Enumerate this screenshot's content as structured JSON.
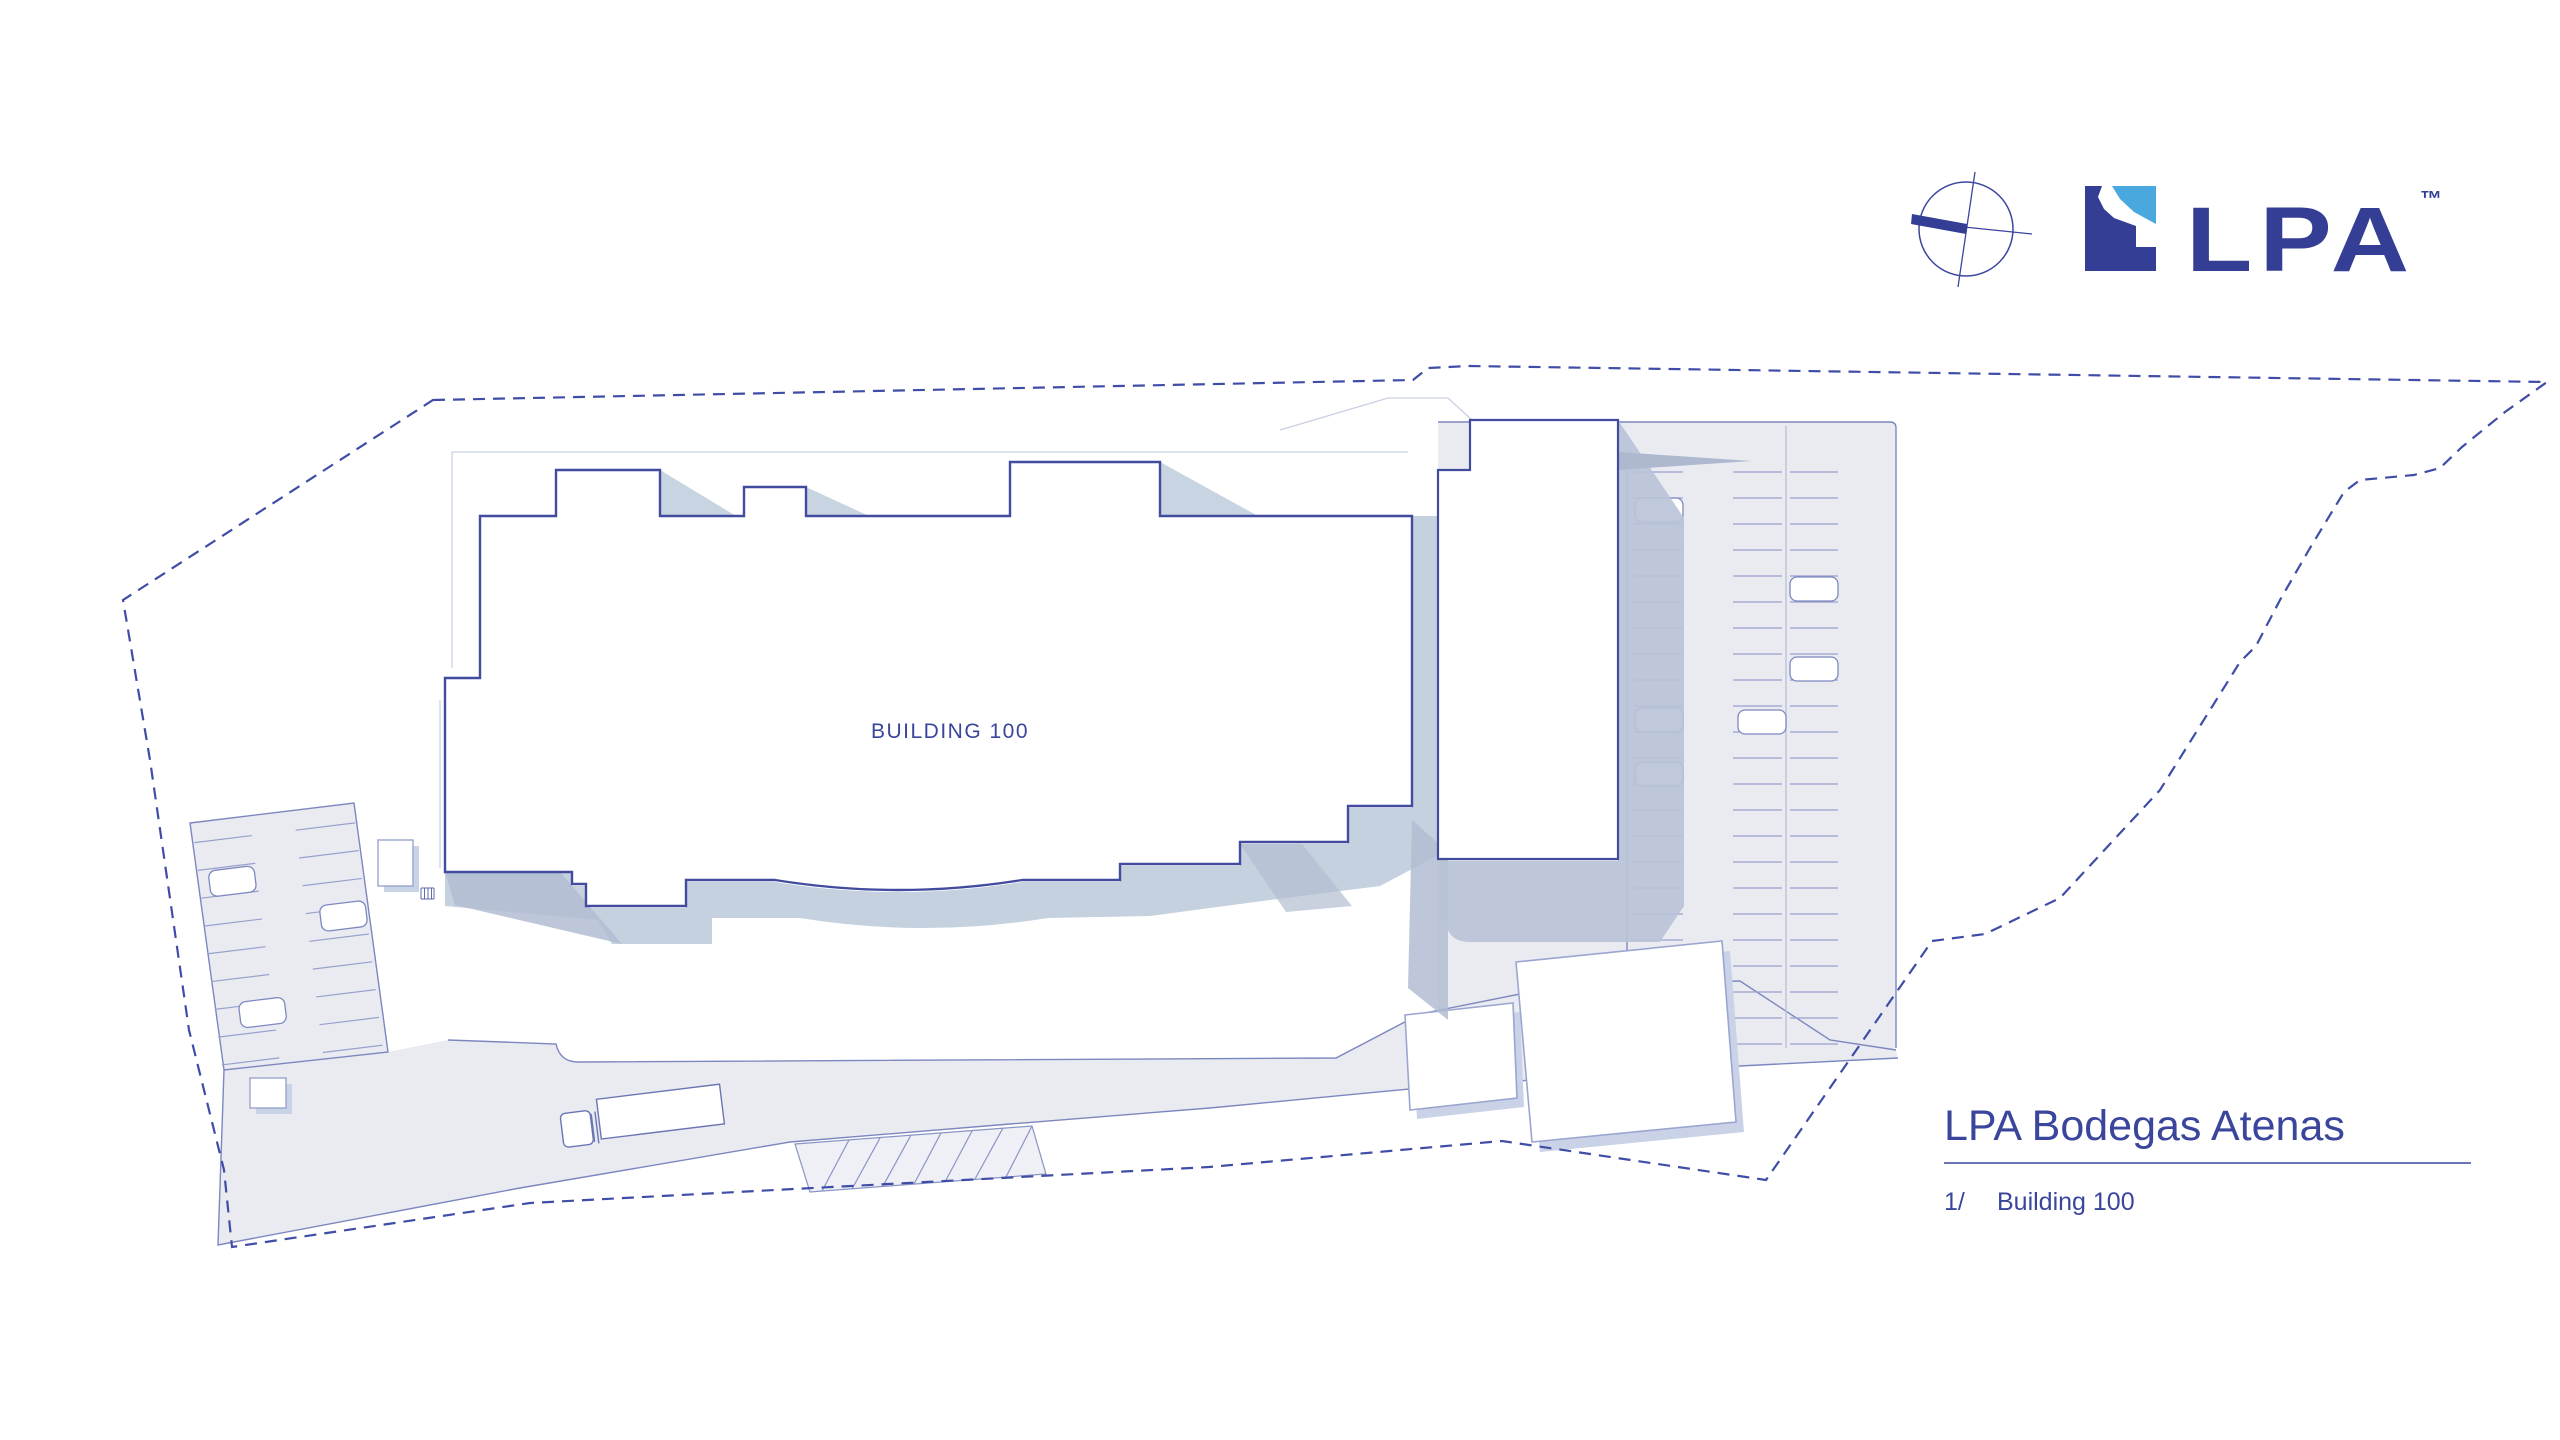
{
  "canvas": {
    "width": 2560,
    "height": 1440,
    "background": "#ffffff"
  },
  "branding": {
    "logo_text": "LPA",
    "logo_trademark": "™",
    "logo_dark_color": "#333e94",
    "logo_accent_color": "#49a8de",
    "compass_icon": "north-arrow-compass"
  },
  "plan": {
    "building_label": "BUILDING 100",
    "colors": {
      "building_outline": "#414c9e",
      "boundary_dash": "#3f4da6",
      "pavement": "#e9ebf1",
      "road_edge": "#7d87bf",
      "shadow_light": "#c5d1df",
      "shadow_dark": "#b2bdd2",
      "stall_line": "#97a1cc",
      "canopy_line": "#c9cfe4",
      "label_text": "#3a459c"
    },
    "left_parking_cars": [
      {
        "x": 12,
        "y": 50
      },
      {
        "x": 118,
        "y": 98
      },
      {
        "x": 26,
        "y": 184
      }
    ],
    "right_parking_cars": [
      {
        "x": 1635,
        "y": 498
      },
      {
        "x": 1790,
        "y": 577
      },
      {
        "x": 1790,
        "y": 657
      },
      {
        "x": 1635,
        "y": 708
      },
      {
        "x": 1738,
        "y": 710
      },
      {
        "x": 1635,
        "y": 762
      }
    ]
  },
  "title_block": {
    "project_title": "LPA Bodegas Atenas",
    "sheet_number": "1/",
    "sheet_name": "Building 100"
  }
}
